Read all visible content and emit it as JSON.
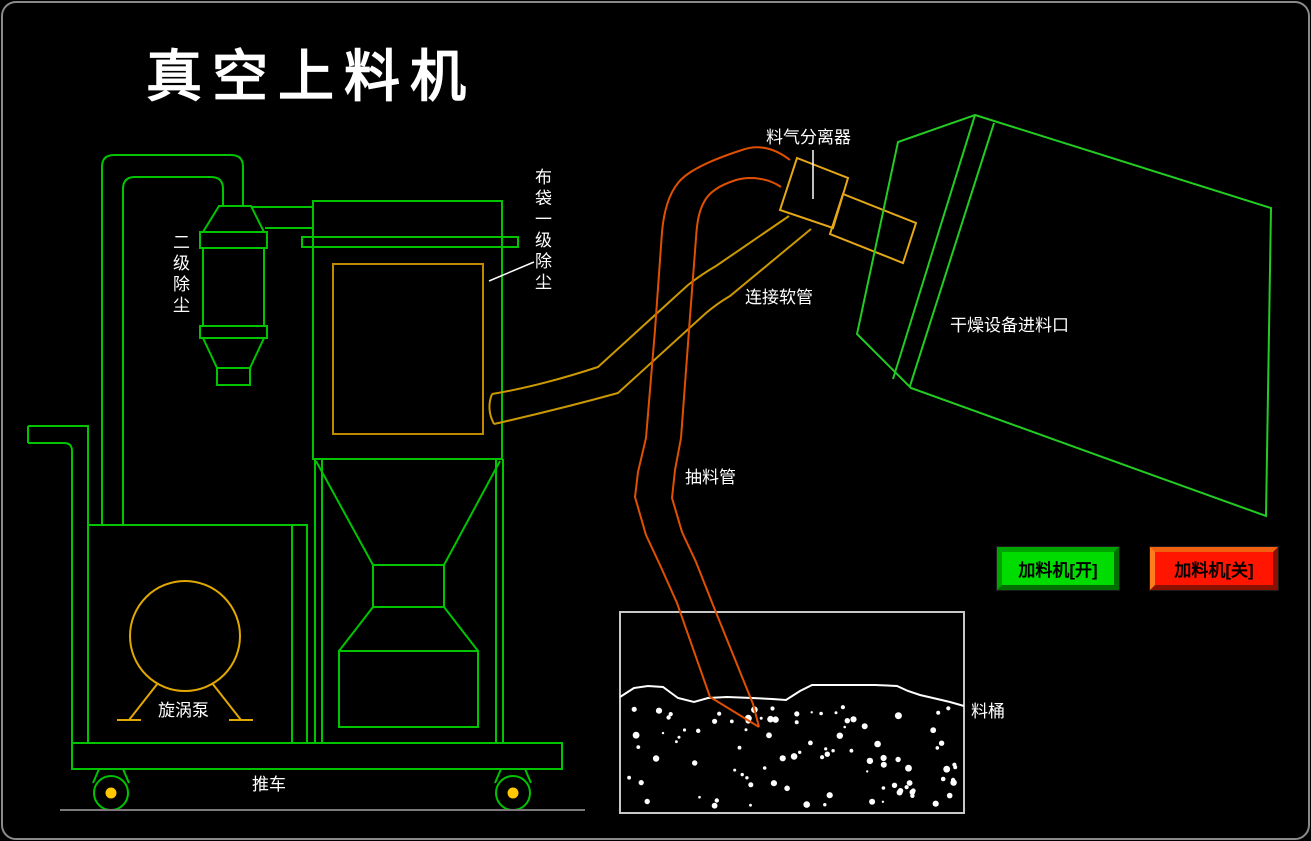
{
  "title": "真空上料机",
  "labels": {
    "separator": "料气分离器",
    "bag_filter_primary": "布袋一级除尘",
    "secondary_dust": "二级除尘",
    "hose": "连接软管",
    "dryer_inlet": "干燥设备进料口",
    "suction_pipe": "抽料管",
    "vortex_pump": "旋涡泵",
    "cart": "推车",
    "material_barrel": "料桶"
  },
  "buttons": {
    "feeder_on": {
      "label": "加料机[开]",
      "color": "#00DC00"
    },
    "feeder_off": {
      "label": "加料机[关]",
      "color": "#FF1500"
    }
  },
  "colors": {
    "background": "#000000",
    "machine_green": "#00C400",
    "container_green": "#22CC22",
    "bag_yellow": "#C08A00",
    "component_yellow": "#E6A817",
    "hose_yellow": "#CC9900",
    "pipe_orange": "#E05000",
    "wheel_hub_yellow": "#FFC800",
    "barrel_gray": "#C8C8C8",
    "text_white": "#FFFFFF"
  }
}
